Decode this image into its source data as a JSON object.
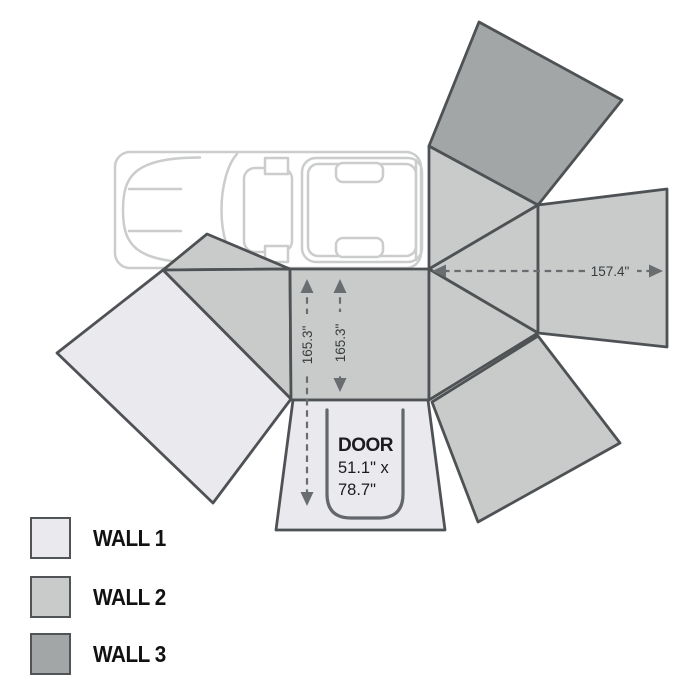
{
  "dimensions": {
    "panel_width": "157.4\"",
    "wall_height_outer": "165.3\"",
    "wall_height_inner": "165.3\""
  },
  "door": {
    "label": "DOOR",
    "size_line1": "51.1\" x",
    "size_line2": "78.7\""
  },
  "legend": [
    {
      "label": "WALL 1",
      "color": "#e9e9ee"
    },
    {
      "label": "WALL 2",
      "color": "#c8cbca"
    },
    {
      "label": "WALL 3",
      "color": "#a3a6a7"
    }
  ],
  "colors": {
    "wall1": "#e9e9ee",
    "wall2": "#c8cbca",
    "wall3": "#a3a6a7",
    "panel_outline": "#4f5255",
    "door_outline": "#63666a",
    "dimension": "#696d6f",
    "dimension_text": "#383b3d",
    "door_text": "#1c1c1e",
    "vehicle": "#cbcdcd"
  }
}
